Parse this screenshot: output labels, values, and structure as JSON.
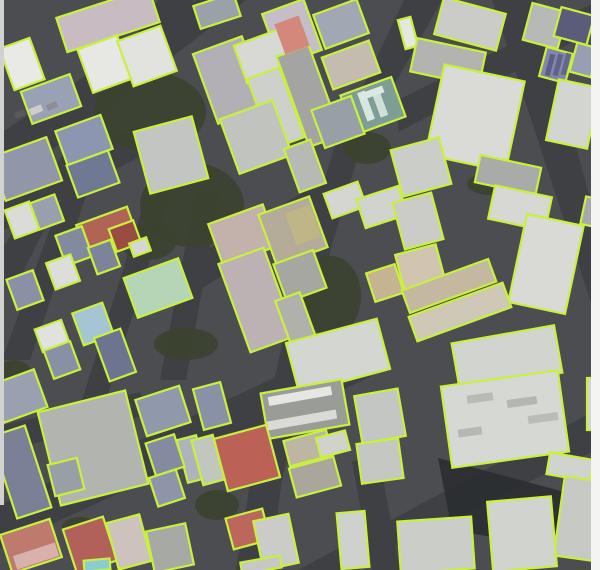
{
  "map_data": {
    "type": "satellite-building-footprint-overlay",
    "canvas": {
      "width": 600,
      "height": 570
    },
    "palette": {
      "outline": "#c7f13c",
      "outline_width": 2.2,
      "ground": "#4b4d50",
      "road": "#3e4043",
      "tree": "#3b432f",
      "shadow": "#2a2c2f",
      "left_margin_strip": "#d2d2d0",
      "right_margin_strip": "#f4f4f2"
    },
    "margins": {
      "left_strip": {
        "x": 0,
        "y": 0,
        "w": 4,
        "h": 505
      },
      "right_strip": {
        "x": 591,
        "y": 0,
        "w": 9,
        "h": 570
      }
    },
    "roads": [
      {
        "pts": "0,134 196,0 246,0 0,190"
      },
      {
        "pts": "158,0 194,0 100,118 18,282 0,282 0,252 90,112"
      },
      {
        "pts": "404,0 442,0 362,142 330,252 304,382 282,480 270,570 236,570 252,470 276,372 300,262 334,148"
      },
      {
        "pts": "492,0 536,0 600,235 600,330"
      },
      {
        "pts": "0,505 352,342 372,376 0,548"
      },
      {
        "pts": "298,570 600,408 600,448 345,570"
      },
      {
        "pts": "186,262 344,168 352,196 186,298"
      },
      {
        "pts": "0,200 136,126 148,152 0,232"
      },
      {
        "pts": "64,190 88,190 30,360 2,360"
      },
      {
        "pts": "148,190 172,190 96,432 72,432"
      },
      {
        "pts": "398,100 600,0 600,28 398,132"
      },
      {
        "pts": "352,462 378,452 400,570 372,570"
      },
      {
        "pts": "0,426 140,392 150,414 0,452"
      },
      {
        "pts": "196,190 220,190 186,380 160,380"
      }
    ],
    "trees": [
      {
        "cx": 150,
        "cy": 112,
        "rx": 56,
        "ry": 40
      },
      {
        "cx": 192,
        "cy": 205,
        "rx": 52,
        "ry": 42
      },
      {
        "cx": 148,
        "cy": 242,
        "rx": 28,
        "ry": 18
      },
      {
        "cx": 331,
        "cy": 296,
        "rx": 30,
        "ry": 40
      },
      {
        "cx": 367,
        "cy": 148,
        "rx": 24,
        "ry": 16
      },
      {
        "cx": 14,
        "cy": 374,
        "rx": 18,
        "ry": 14
      },
      {
        "cx": 186,
        "cy": 344,
        "rx": 32,
        "ry": 16
      },
      {
        "cx": 217,
        "cy": 505,
        "rx": 22,
        "ry": 15
      },
      {
        "cx": 80,
        "cy": 527,
        "rx": 18,
        "ry": 10
      },
      {
        "cx": 489,
        "cy": 184,
        "rx": 22,
        "ry": 11
      }
    ],
    "shadows": [
      {
        "pts": "438,458 572,494 556,548 452,530",
        "f": "#2a2c2f"
      }
    ],
    "buildings": [
      {
        "cx": 108,
        "cy": 20,
        "w": 97,
        "h": 36,
        "a": -18,
        "f": "#c8bcc2"
      },
      {
        "cx": 105,
        "cy": 64,
        "w": 42,
        "h": 46,
        "a": -20,
        "f": "#e7e7e3"
      },
      {
        "cx": 147,
        "cy": 56,
        "w": 46,
        "h": 48,
        "a": -20,
        "f": "#e2e3df"
      },
      {
        "cx": 22,
        "cy": 64,
        "w": 32,
        "h": 44,
        "a": -20,
        "f": "#e9eae6"
      },
      {
        "cx": 51,
        "cy": 99,
        "w": 52,
        "h": 34,
        "a": -20,
        "f": "#99a1b5"
      },
      {
        "cx": 84,
        "cy": 140,
        "w": 48,
        "h": 36,
        "a": -20,
        "f": "#8c96b1"
      },
      {
        "cx": 26,
        "cy": 169,
        "w": 60,
        "h": 46,
        "a": -20,
        "f": "#9197a8"
      },
      {
        "cx": 93,
        "cy": 174,
        "w": 44,
        "h": 34,
        "a": -20,
        "f": "#6f7993"
      },
      {
        "cx": 171,
        "cy": 155,
        "w": 60,
        "h": 64,
        "a": -15,
        "f": "#c2c5c1"
      },
      {
        "cx": 217,
        "cy": 11,
        "w": 42,
        "h": 24,
        "a": -18,
        "f": "#9ba1a9"
      },
      {
        "cx": 292,
        "cy": 32,
        "w": 44,
        "h": 54,
        "a": -20,
        "f": "#c5bec9"
      },
      {
        "cx": 341,
        "cy": 24,
        "w": 46,
        "h": 36,
        "a": -20,
        "f": "#a1a7b3"
      },
      {
        "cx": 230,
        "cy": 80,
        "w": 52,
        "h": 74,
        "a": -20,
        "f": "#b2b0b5"
      },
      {
        "cx": 264,
        "cy": 56,
        "w": 50,
        "h": 40,
        "a": -20,
        "f": "#d8d9d5"
      },
      {
        "cx": 276,
        "cy": 108,
        "w": 34,
        "h": 74,
        "a": -20,
        "f": "#ced0cc"
      },
      {
        "cx": 309,
        "cy": 96,
        "w": 34,
        "h": 96,
        "a": -20,
        "f": "#a4a4a2"
      },
      {
        "cx": 373,
        "cy": 106,
        "w": 54,
        "h": 42,
        "a": -20,
        "f": "#7e9d95"
      },
      {
        "cx": 351,
        "cy": 65,
        "w": 50,
        "h": 34,
        "a": -20,
        "f": "#c3bcaf"
      },
      {
        "cx": 256,
        "cy": 137,
        "w": 56,
        "h": 58,
        "a": -20,
        "f": "#c1c3bf"
      },
      {
        "cx": 338,
        "cy": 122,
        "w": 42,
        "h": 40,
        "a": -20,
        "f": "#999fa7"
      },
      {
        "cx": 305,
        "cy": 166,
        "w": 28,
        "h": 46,
        "a": -20,
        "f": "#b7b9b5"
      },
      {
        "cx": 470,
        "cy": 24,
        "w": 64,
        "h": 38,
        "a": 15,
        "f": "#cbcbc7"
      },
      {
        "cx": 408,
        "cy": 33,
        "w": 13,
        "h": 30,
        "a": -15,
        "f": "#e7e7e1"
      },
      {
        "cx": 448,
        "cy": 62,
        "w": 70,
        "h": 34,
        "a": 12,
        "f": "#b3b3af"
      },
      {
        "cx": 475,
        "cy": 118,
        "w": 82,
        "h": 92,
        "a": 12,
        "f": "#dadbd7"
      },
      {
        "cx": 545,
        "cy": 26,
        "w": 36,
        "h": 38,
        "a": 15,
        "f": "#b7b9b7"
      },
      {
        "cx": 574,
        "cy": 26,
        "w": 34,
        "h": 30,
        "a": 15,
        "f": "#5a5c7a"
      },
      {
        "cx": 556,
        "cy": 65,
        "w": 27,
        "h": 30,
        "a": 15,
        "f": "#8385ab"
      },
      {
        "cx": 584,
        "cy": 60,
        "w": 22,
        "h": 30,
        "a": 15,
        "f": "#989fb3"
      },
      {
        "cx": 573,
        "cy": 114,
        "w": 42,
        "h": 62,
        "a": 12,
        "f": "#d3d5d1"
      },
      {
        "cx": 508,
        "cy": 175,
        "w": 62,
        "h": 28,
        "a": 12,
        "f": "#a8aba8"
      },
      {
        "cx": 421,
        "cy": 167,
        "w": 50,
        "h": 48,
        "a": -15,
        "f": "#cbcdc9"
      },
      {
        "cx": 22,
        "cy": 220,
        "w": 26,
        "h": 30,
        "a": -20,
        "f": "#dbdbd7"
      },
      {
        "cx": 47,
        "cy": 212,
        "w": 26,
        "h": 28,
        "a": -20,
        "f": "#99a0ad"
      },
      {
        "cx": 107,
        "cy": 231,
        "w": 54,
        "h": 32,
        "a": -20,
        "f": "#b16456"
      },
      {
        "cx": 125,
        "cy": 236,
        "w": 26,
        "h": 24,
        "a": -20,
        "f": "#9a4b42"
      },
      {
        "cx": 74,
        "cy": 246,
        "w": 28,
        "h": 32,
        "a": -20,
        "f": "#838aa0"
      },
      {
        "cx": 63,
        "cy": 272,
        "w": 26,
        "h": 28,
        "a": -20,
        "f": "#dddeda"
      },
      {
        "cx": 104,
        "cy": 257,
        "w": 24,
        "h": 28,
        "a": -20,
        "f": "#7d8399"
      },
      {
        "cx": 140,
        "cy": 247,
        "w": 18,
        "h": 14,
        "a": -20,
        "f": "#d7d7d1"
      },
      {
        "cx": 25,
        "cy": 290,
        "w": 28,
        "h": 32,
        "a": -20,
        "f": "#8a90a6"
      },
      {
        "cx": 158,
        "cy": 288,
        "w": 58,
        "h": 42,
        "a": -20,
        "f": "#b4d6b7"
      },
      {
        "cx": 93,
        "cy": 324,
        "w": 32,
        "h": 34,
        "a": -20,
        "f": "#a5c5d5"
      },
      {
        "cx": 52,
        "cy": 336,
        "w": 28,
        "h": 24,
        "a": -20,
        "f": "#e1e2de"
      },
      {
        "cx": 62,
        "cy": 360,
        "w": 28,
        "h": 30,
        "a": -20,
        "f": "#8890a6"
      },
      {
        "cx": 115,
        "cy": 355,
        "w": 28,
        "h": 46,
        "a": -20,
        "f": "#6c7490"
      },
      {
        "cx": 19,
        "cy": 396,
        "w": 46,
        "h": 40,
        "a": -20,
        "f": "#99a0b0"
      },
      {
        "cx": 243,
        "cy": 235,
        "w": 58,
        "h": 44,
        "a": -20,
        "f": "#c3b1ab"
      },
      {
        "cx": 257,
        "cy": 300,
        "w": 48,
        "h": 94,
        "a": -20,
        "f": "#bcb2b3"
      },
      {
        "cx": 293,
        "cy": 231,
        "w": 54,
        "h": 54,
        "a": -20,
        "f": "#b4ac99"
      },
      {
        "cx": 300,
        "cy": 276,
        "w": 42,
        "h": 40,
        "a": -20,
        "f": "#a7a7a1"
      },
      {
        "cx": 297,
        "cy": 323,
        "w": 26,
        "h": 56,
        "a": -20,
        "f": "#b1b1ab"
      },
      {
        "cx": 345,
        "cy": 200,
        "w": 36,
        "h": 26,
        "a": -20,
        "f": "#d5d6d2"
      },
      {
        "cx": 382,
        "cy": 207,
        "w": 44,
        "h": 30,
        "a": -18,
        "f": "#d1d3cf"
      },
      {
        "cx": 385,
        "cy": 283,
        "w": 30,
        "h": 30,
        "a": -18,
        "f": "#c5b391"
      },
      {
        "cx": 418,
        "cy": 221,
        "w": 40,
        "h": 48,
        "a": -15,
        "f": "#cbcbc7"
      },
      {
        "cx": 520,
        "cy": 208,
        "w": 58,
        "h": 34,
        "a": 12,
        "f": "#d7d8d4"
      },
      {
        "cx": 546,
        "cy": 264,
        "w": 58,
        "h": 90,
        "a": 12,
        "f": "#d9dad6"
      },
      {
        "cx": 420,
        "cy": 267,
        "w": 42,
        "h": 36,
        "a": -15,
        "f": "#d1c5b1"
      },
      {
        "cx": 449,
        "cy": 286,
        "w": 92,
        "h": 24,
        "a": -20,
        "f": "#c4b8a0"
      },
      {
        "cx": 460,
        "cy": 312,
        "w": 100,
        "h": 26,
        "a": -20,
        "f": "#cfc8b6"
      },
      {
        "cx": 338,
        "cy": 356,
        "w": 94,
        "h": 52,
        "a": -15,
        "f": "#d4d6d2"
      },
      {
        "cx": 507,
        "cy": 358,
        "w": 104,
        "h": 48,
        "a": -10,
        "f": "#d2d4d0"
      },
      {
        "cx": 592,
        "cy": 212,
        "w": 18,
        "h": 28,
        "a": 12,
        "f": "#a7a9af"
      },
      {
        "cx": 21,
        "cy": 472,
        "w": 36,
        "h": 86,
        "a": -18,
        "f": "#7a8095"
      },
      {
        "cx": 93,
        "cy": 448,
        "w": 90,
        "h": 96,
        "a": -14,
        "f": "#b2b4b0"
      },
      {
        "cx": 66,
        "cy": 477,
        "w": 30,
        "h": 32,
        "a": -14,
        "f": "#999fa7"
      },
      {
        "cx": 163,
        "cy": 411,
        "w": 46,
        "h": 38,
        "a": -18,
        "f": "#9098ac"
      },
      {
        "cx": 192,
        "cy": 459,
        "w": 20,
        "h": 44,
        "a": -15,
        "f": "#afb3bb"
      },
      {
        "cx": 165,
        "cy": 455,
        "w": 30,
        "h": 34,
        "a": -18,
        "f": "#848ba1"
      },
      {
        "cx": 167,
        "cy": 488,
        "w": 28,
        "h": 30,
        "a": -18,
        "f": "#8f95a9"
      },
      {
        "cx": 31,
        "cy": 546,
        "w": 52,
        "h": 40,
        "a": -18,
        "f": "#bf7a6e"
      },
      {
        "cx": 90,
        "cy": 545,
        "w": 42,
        "h": 46,
        "a": -18,
        "f": "#b1615a"
      },
      {
        "cx": 129,
        "cy": 542,
        "w": 34,
        "h": 48,
        "a": -15,
        "f": "#cec2bc"
      },
      {
        "cx": 170,
        "cy": 548,
        "w": 40,
        "h": 42,
        "a": -12,
        "f": "#a7a9a5"
      },
      {
        "cx": 212,
        "cy": 406,
        "w": 28,
        "h": 42,
        "a": -15,
        "f": "#8991a7"
      },
      {
        "cx": 305,
        "cy": 409,
        "w": 82,
        "h": 46,
        "a": -10,
        "f": "#9a9c98"
      },
      {
        "cx": 380,
        "cy": 416,
        "w": 44,
        "h": 48,
        "a": -10,
        "f": "#c3c6c2"
      },
      {
        "cx": 247,
        "cy": 458,
        "w": 54,
        "h": 54,
        "a": -15,
        "f": "#bc6156"
      },
      {
        "cx": 208,
        "cy": 460,
        "w": 22,
        "h": 46,
        "a": -15,
        "f": "#c1c7bc"
      },
      {
        "cx": 308,
        "cy": 448,
        "w": 44,
        "h": 26,
        "a": -15,
        "f": "#bdb6a2"
      },
      {
        "cx": 315,
        "cy": 477,
        "w": 46,
        "h": 30,
        "a": -15,
        "f": "#aba69b"
      },
      {
        "cx": 333,
        "cy": 444,
        "w": 30,
        "h": 20,
        "a": -15,
        "f": "#d1d2ce"
      },
      {
        "cx": 380,
        "cy": 461,
        "w": 42,
        "h": 40,
        "a": -8,
        "f": "#c5c7c3"
      },
      {
        "cx": 248,
        "cy": 529,
        "w": 38,
        "h": 32,
        "a": -15,
        "f": "#bc675b"
      },
      {
        "cx": 276,
        "cy": 542,
        "w": 36,
        "h": 50,
        "a": -12,
        "f": "#cbcbc7"
      },
      {
        "cx": 353,
        "cy": 540,
        "w": 28,
        "h": 56,
        "a": -5,
        "f": "#cfd1cd"
      },
      {
        "cx": 261,
        "cy": 565,
        "w": 40,
        "h": 12,
        "a": -10,
        "f": "#c7c7c3"
      },
      {
        "cx": 97,
        "cy": 565,
        "w": 26,
        "h": 11,
        "a": -5,
        "f": "#8bccd3"
      },
      {
        "cx": 505,
        "cy": 419,
        "w": 118,
        "h": 82,
        "a": -8,
        "f": "#d6d8d4"
      },
      {
        "cx": 594,
        "cy": 404,
        "w": 14,
        "h": 52,
        "a": 0,
        "f": "#d3d5d1"
      },
      {
        "cx": 570,
        "cy": 467,
        "w": 44,
        "h": 22,
        "a": 10,
        "f": "#d1d3cf"
      },
      {
        "cx": 582,
        "cy": 519,
        "w": 46,
        "h": 80,
        "a": 8,
        "f": "#c7c9c5"
      },
      {
        "cx": 522,
        "cy": 534,
        "w": 64,
        "h": 70,
        "a": -5,
        "f": "#d1d3cf"
      },
      {
        "cx": 436,
        "cy": 545,
        "w": 74,
        "h": 52,
        "a": -4,
        "f": "#cbcdc9"
      }
    ],
    "details": [
      {
        "cx": 292,
        "cy": 35,
        "w": 26,
        "h": 32,
        "a": -20,
        "f": "#d4887c"
      },
      {
        "cx": 303,
        "cy": 225,
        "w": 26,
        "h": 34,
        "a": -20,
        "f": "#bfb687"
      },
      {
        "cx": 366,
        "cy": 106,
        "w": 8,
        "h": 30,
        "a": -20,
        "f": "#d8e6e0"
      },
      {
        "cx": 380,
        "cy": 104,
        "w": 8,
        "h": 26,
        "a": -20,
        "f": "#cfe0da"
      },
      {
        "cx": 372,
        "cy": 93,
        "w": 24,
        "h": 7,
        "a": -20,
        "f": "#dce8e2"
      },
      {
        "cx": 550,
        "cy": 65,
        "w": 5,
        "h": 22,
        "a": 15,
        "f": "#5c5e86"
      },
      {
        "cx": 558,
        "cy": 65,
        "w": 5,
        "h": 22,
        "a": 15,
        "f": "#60628a"
      },
      {
        "cx": 566,
        "cy": 64,
        "w": 5,
        "h": 22,
        "a": 15,
        "f": "#64668e"
      },
      {
        "cx": 300,
        "cy": 396,
        "w": 64,
        "h": 9,
        "a": -10,
        "f": "#e6e6e2"
      },
      {
        "cx": 302,
        "cy": 420,
        "w": 70,
        "h": 9,
        "a": -10,
        "f": "#dadad6"
      },
      {
        "cx": 36,
        "cy": 556,
        "w": 44,
        "h": 14,
        "a": -18,
        "f": "#d8b1ad"
      },
      {
        "cx": 480,
        "cy": 398,
        "w": 26,
        "h": 8,
        "a": -8,
        "f": "#b8bab6"
      },
      {
        "cx": 522,
        "cy": 402,
        "w": 30,
        "h": 8,
        "a": -8,
        "f": "#b4b6b2"
      },
      {
        "cx": 543,
        "cy": 418,
        "w": 30,
        "h": 8,
        "a": -8,
        "f": "#babcb8"
      },
      {
        "cx": 470,
        "cy": 432,
        "w": 24,
        "h": 8,
        "a": -8,
        "f": "#b6b8b4"
      }
    ],
    "cars": [
      {
        "cx": 36,
        "cy": 110,
        "w": 13,
        "h": 7,
        "a": -22,
        "f": "#cdcdc9"
      },
      {
        "cx": 20,
        "cy": 114,
        "w": 11,
        "h": 6,
        "a": -22,
        "f": "#59595c"
      },
      {
        "cx": 52,
        "cy": 106,
        "w": 11,
        "h": 6,
        "a": -22,
        "f": "#8e8e90"
      }
    ]
  }
}
